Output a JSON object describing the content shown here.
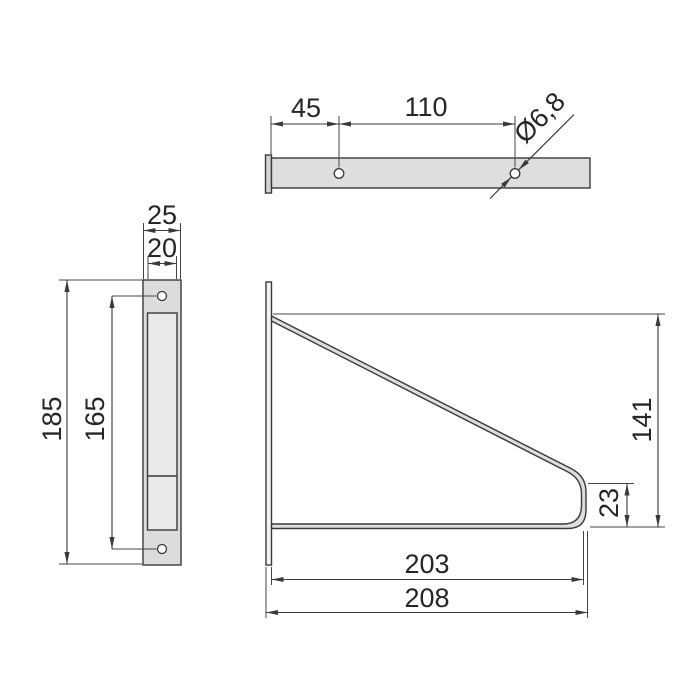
{
  "page": {
    "background": "#ffffff",
    "width": 700,
    "height": 700
  },
  "colors": {
    "line": "#3a3a3a",
    "dimension_line": "#454545",
    "text": "#262626",
    "part_fill": "#dedede",
    "part_fill_light": "#e9e9e9",
    "plate_fill": "#f4f4f4",
    "hole_fill": "#ffffff"
  },
  "drawing": {
    "type": "technical-drawing",
    "subject": "Wall-mounted shelf bracket shown in three orthographic views with dimensions",
    "units": "mm",
    "dimensions": {
      "top_hole_offset": {
        "label": "45",
        "value": 45
      },
      "top_hole_spacing": {
        "label": "110",
        "value": 110
      },
      "hole_diameter": {
        "label": "Ø6,8",
        "value": 6.8
      },
      "plate_outer_width": {
        "label": "25",
        "value": 25
      },
      "plate_inner_width": {
        "label": "20",
        "value": 20
      },
      "plate_height": {
        "label": "185",
        "value": 185
      },
      "plate_hole_pitch": {
        "label": "165",
        "value": 165
      },
      "bracket_height": {
        "label": "141",
        "value": 141
      },
      "tip_height": {
        "label": "23",
        "value": 23
      },
      "arm_depth_inner": {
        "label": "203",
        "value": 203
      },
      "arm_depth_outer": {
        "label": "208",
        "value": 208
      }
    }
  }
}
